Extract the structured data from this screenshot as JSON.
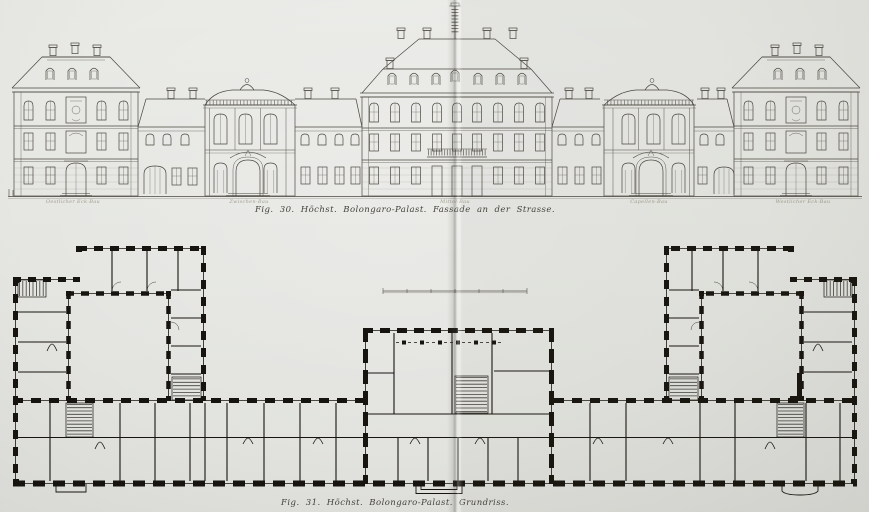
{
  "page": {
    "paper_color": "#e6e7e3",
    "elevation_ink": "#4a473f",
    "plan_ink": "#17140f"
  },
  "figure_30": {
    "caption": "Fig. 30.  Höchst.  Bolongaro-Palast.  Fassade an der Strasse.",
    "pavilion_labels": [
      "Oestlicher Eck-Bau",
      "Zwischen-Bau",
      "Mittel-Bau",
      "Capellen-Bau",
      "Westlicher Eck-Bau"
    ]
  },
  "figure_31": {
    "caption": "Fig. 31.  Höchst.  Bolongaro-Palast.  Grundriss."
  }
}
